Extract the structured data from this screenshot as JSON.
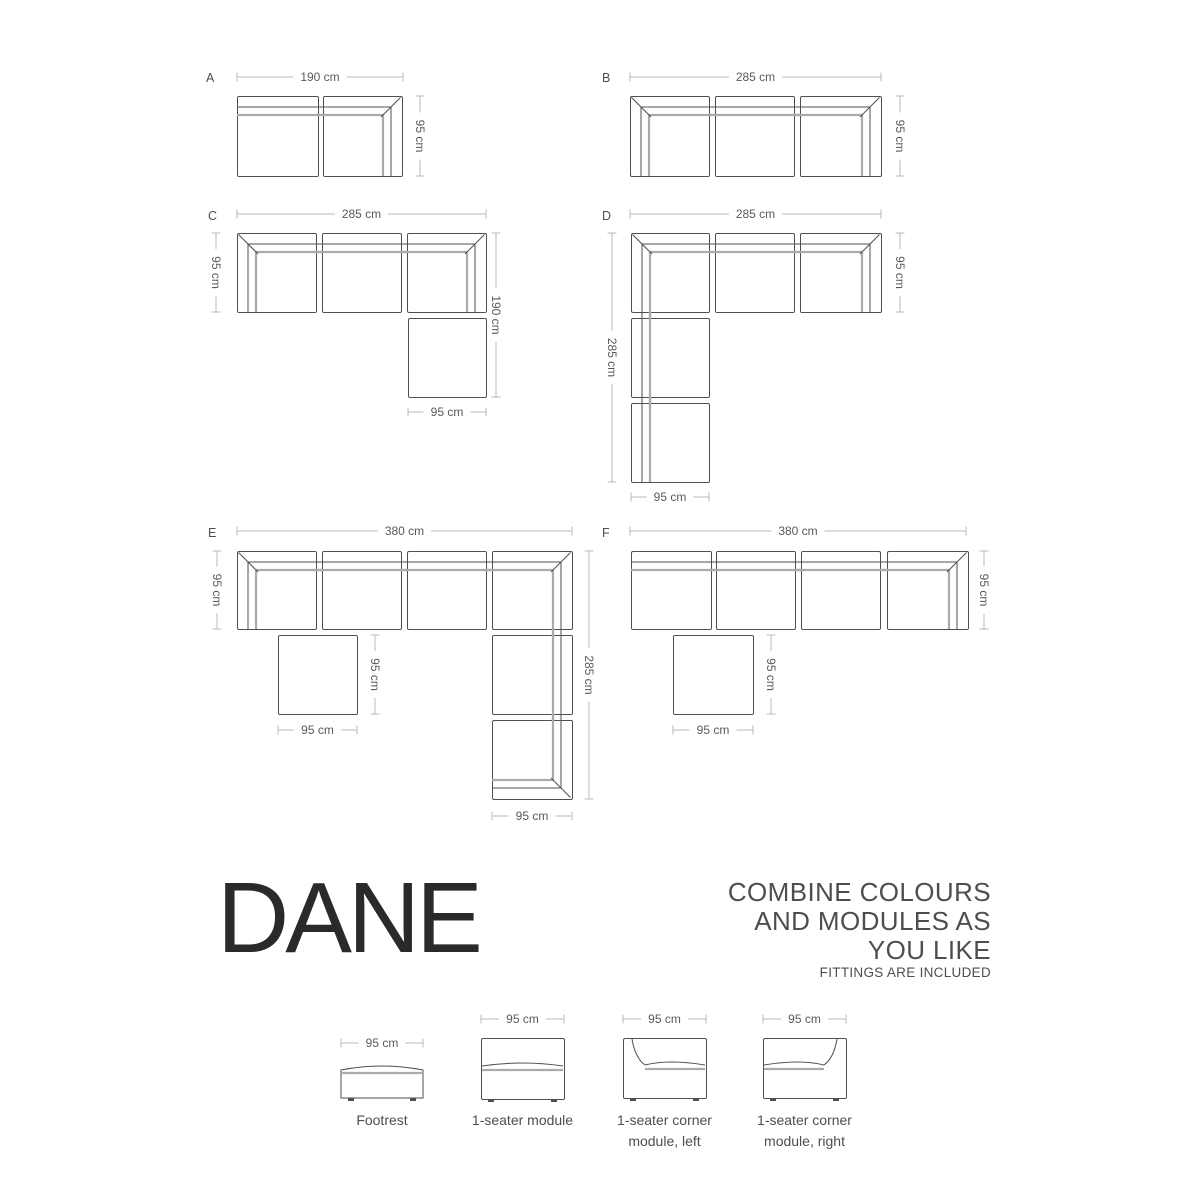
{
  "brand": {
    "title": "DANE"
  },
  "tagline": {
    "lines": [
      "COMBINE COLOURS",
      "AND MODULES AS",
      "YOU LIKE"
    ],
    "note": "FITTINGS ARE INCLUDED"
  },
  "colors": {
    "bg": "#ffffff",
    "outline": "#4e4f51",
    "cushion": "#a9abad",
    "dim": "#b7b9bb",
    "text": "#58595b",
    "body": "#4d4e50",
    "brand": "#2c292a"
  },
  "diagrams": [
    {
      "letter": "A",
      "letter_x": 206,
      "letter_y": 82,
      "modules": [
        {
          "type": "seat_top",
          "x": 237,
          "y": 96,
          "w": 81,
          "h": 80,
          "bridge": "r"
        },
        {
          "type": "corner_tr",
          "x": 323,
          "y": 96,
          "w": 79,
          "h": 80,
          "bridge": "l"
        }
      ],
      "dims": [
        {
          "o": "h",
          "x1": 237,
          "x2": 403,
          "y": 77,
          "label": "190 cm"
        },
        {
          "o": "v",
          "x": 420,
          "y1": 96,
          "y2": 176,
          "label": "95 cm"
        }
      ]
    },
    {
      "letter": "B",
      "letter_x": 602,
      "letter_y": 82,
      "modules": [
        {
          "type": "corner_tl",
          "x": 630,
          "y": 96,
          "w": 79,
          "h": 80,
          "bridge": "r"
        },
        {
          "type": "seat_top",
          "x": 715,
          "y": 96,
          "w": 79,
          "h": 80,
          "bridge": "lr"
        },
        {
          "type": "corner_tr",
          "x": 800,
          "y": 96,
          "w": 81,
          "h": 80,
          "bridge": "l"
        }
      ],
      "dims": [
        {
          "o": "h",
          "x1": 630,
          "x2": 881,
          "y": 77,
          "label": "285 cm"
        },
        {
          "o": "v",
          "x": 900,
          "y1": 96,
          "y2": 176,
          "label": "95 cm"
        }
      ]
    },
    {
      "letter": "C",
      "letter_x": 208,
      "letter_y": 220,
      "modules": [
        {
          "type": "corner_tl",
          "x": 237,
          "y": 233,
          "w": 79,
          "h": 79,
          "bridge": "r"
        },
        {
          "type": "seat_top",
          "x": 322,
          "y": 233,
          "w": 79,
          "h": 79,
          "bridge": "lr"
        },
        {
          "type": "corner_tr",
          "x": 407,
          "y": 233,
          "w": 79,
          "h": 79,
          "bridge": "l"
        },
        {
          "type": "footrest",
          "x": 408,
          "y": 318,
          "w": 78,
          "h": 79,
          "bridge": ""
        }
      ],
      "dims": [
        {
          "o": "h",
          "x1": 237,
          "x2": 486,
          "y": 214,
          "label": "285 cm"
        },
        {
          "o": "v",
          "x": 216,
          "y1": 233,
          "y2": 312,
          "label": "95 cm"
        },
        {
          "o": "v",
          "x": 496,
          "y1": 233,
          "y2": 397,
          "label": "190 cm"
        },
        {
          "o": "h",
          "x1": 408,
          "x2": 486,
          "y": 412,
          "label": "95 cm"
        }
      ]
    },
    {
      "letter": "D",
      "letter_x": 602,
      "letter_y": 220,
      "modules": [
        {
          "type": "corner_tl",
          "x": 631,
          "y": 233,
          "w": 78,
          "h": 79,
          "bridge": "rb"
        },
        {
          "type": "seat_top",
          "x": 715,
          "y": 233,
          "w": 79,
          "h": 79,
          "bridge": "lr"
        },
        {
          "type": "corner_tr",
          "x": 800,
          "y": 233,
          "w": 81,
          "h": 79,
          "bridge": "l"
        },
        {
          "type": "seat_left",
          "x": 631,
          "y": 318,
          "w": 78,
          "h": 79,
          "bridge": "tb"
        },
        {
          "type": "seat_left",
          "x": 631,
          "y": 403,
          "w": 78,
          "h": 79,
          "bridge": "t"
        }
      ],
      "dims": [
        {
          "o": "h",
          "x1": 630,
          "x2": 881,
          "y": 214,
          "label": "285 cm"
        },
        {
          "o": "v",
          "x": 612,
          "y1": 233,
          "y2": 482,
          "label": "285 cm"
        },
        {
          "o": "v",
          "x": 900,
          "y1": 233,
          "y2": 312,
          "label": "95 cm"
        },
        {
          "o": "h",
          "x1": 631,
          "x2": 709,
          "y": 497,
          "label": "95 cm"
        }
      ]
    },
    {
      "letter": "E",
      "letter_x": 208,
      "letter_y": 537,
      "modules": [
        {
          "type": "corner_tl",
          "x": 237,
          "y": 551,
          "w": 79,
          "h": 78,
          "bridge": "r"
        },
        {
          "type": "seat_top",
          "x": 322,
          "y": 551,
          "w": 79,
          "h": 78,
          "bridge": "lr"
        },
        {
          "type": "seat_top",
          "x": 407,
          "y": 551,
          "w": 79,
          "h": 78,
          "bridge": "lr"
        },
        {
          "type": "corner_tr",
          "x": 492,
          "y": 551,
          "w": 80,
          "h": 78,
          "bridge": "lb"
        },
        {
          "type": "footrest",
          "x": 278,
          "y": 635,
          "w": 79,
          "h": 79,
          "bridge": ""
        },
        {
          "type": "seat_right",
          "x": 492,
          "y": 635,
          "w": 80,
          "h": 79,
          "bridge": "tb"
        },
        {
          "type": "corner_br",
          "x": 492,
          "y": 720,
          "w": 80,
          "h": 79,
          "bridge": "t"
        }
      ],
      "dims": [
        {
          "o": "h",
          "x1": 237,
          "x2": 572,
          "y": 531,
          "label": "380 cm"
        },
        {
          "o": "v",
          "x": 217,
          "y1": 551,
          "y2": 629,
          "label": "95 cm"
        },
        {
          "o": "v",
          "x": 375,
          "y1": 635,
          "y2": 714,
          "label": "95 cm"
        },
        {
          "o": "h",
          "x1": 278,
          "x2": 357,
          "y": 730,
          "label": "95 cm"
        },
        {
          "o": "v",
          "x": 589,
          "y1": 551,
          "y2": 799,
          "label": "285 cm"
        },
        {
          "o": "h",
          "x1": 492,
          "x2": 572,
          "y": 816,
          "label": "95 cm"
        }
      ]
    },
    {
      "letter": "F",
      "letter_x": 602,
      "letter_y": 537,
      "modules": [
        {
          "type": "seat_top",
          "x": 631,
          "y": 551,
          "w": 80,
          "h": 78,
          "bridge": "r"
        },
        {
          "type": "seat_top",
          "x": 716,
          "y": 551,
          "w": 79,
          "h": 78,
          "bridge": "lr"
        },
        {
          "type": "seat_top",
          "x": 801,
          "y": 551,
          "w": 79,
          "h": 78,
          "bridge": "lr"
        },
        {
          "type": "corner_tr",
          "x": 887,
          "y": 551,
          "w": 81,
          "h": 78,
          "bridge": "l"
        },
        {
          "type": "footrest",
          "x": 673,
          "y": 635,
          "w": 80,
          "h": 79,
          "bridge": ""
        }
      ],
      "dims": [
        {
          "o": "h",
          "x1": 630,
          "x2": 966,
          "y": 531,
          "label": "380 cm"
        },
        {
          "o": "v",
          "x": 984,
          "y1": 551,
          "y2": 629,
          "label": "95 cm"
        },
        {
          "o": "v",
          "x": 771,
          "y1": 635,
          "y2": 714,
          "label": "95 cm"
        },
        {
          "o": "h",
          "x1": 673,
          "x2": 753,
          "y": 730,
          "label": "95 cm"
        }
      ]
    }
  ],
  "legend": {
    "items": [
      {
        "type": "footrest_front",
        "label": "Footrest",
        "dim": "95 cm",
        "x": 341,
        "y": 1063,
        "w": 82,
        "h": 35,
        "dim_y": 1043
      },
      {
        "type": "seat_front",
        "label": "1-seater module",
        "dim": "95 cm",
        "x": 481,
        "y": 1038,
        "w": 83,
        "h": 61,
        "dim_y": 1019
      },
      {
        "type": "corner_left_front",
        "label": "1-seater corner module, left",
        "dim": "95 cm",
        "x": 623,
        "y": 1038,
        "w": 83,
        "h": 60,
        "dim_y": 1019
      },
      {
        "type": "corner_right_front",
        "label": "1-seater corner module, right",
        "dim": "95 cm",
        "x": 763,
        "y": 1038,
        "w": 83,
        "h": 60,
        "dim_y": 1019
      }
    ]
  }
}
